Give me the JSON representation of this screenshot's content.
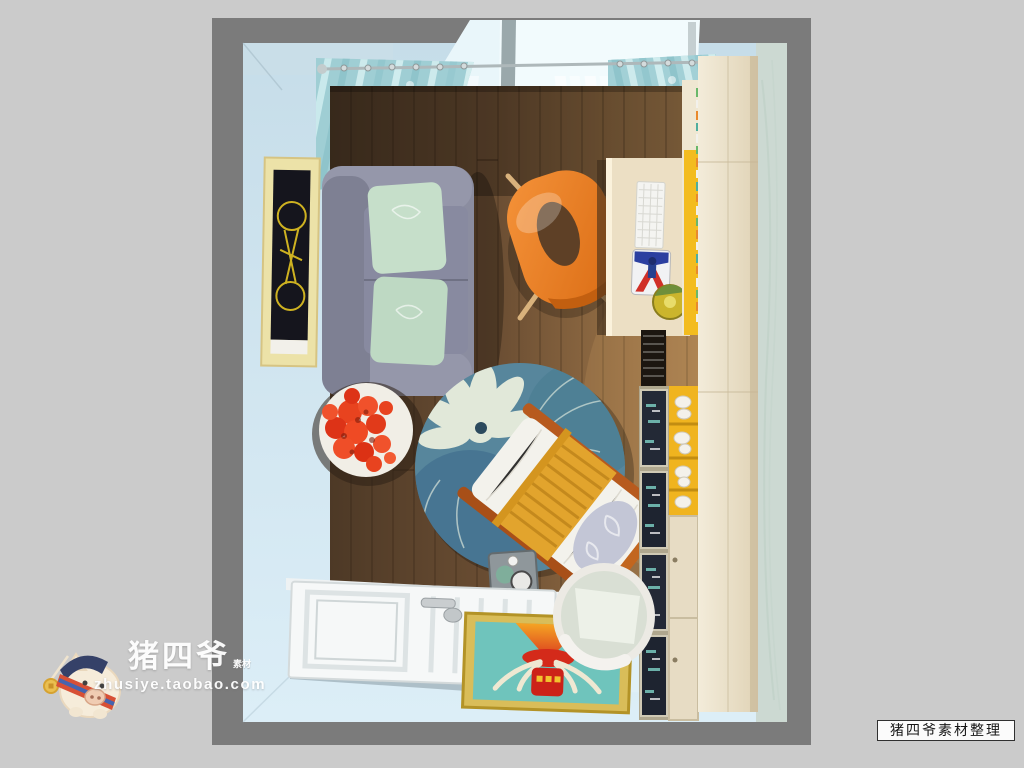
{
  "watermark": {
    "brand": "猪四爷",
    "badge": "素材",
    "url": "zhusiye.taobao.com"
  },
  "footer_label": {
    "text": "猪四爷素材整理"
  },
  "scene": {
    "description_objects": [
      "light-blue-walls",
      "bright-window",
      "curtain-rod",
      "teal-patterned-curtains",
      "white-sheer-curtains",
      "bicycle-wall-art",
      "gray-sofa",
      "mint-pillows",
      "round-side-table",
      "red-rose-bouquet",
      "floral-round-rug",
      "wooden-lounge-chair",
      "yellow-knit-blanket",
      "floral-pillow",
      "tray-stool",
      "orange-designer-chair",
      "desk",
      "white-keyboard",
      "mouse-pad",
      "bookshelf-books",
      "yellow-display-shelf",
      "glass-display-cabinet",
      "wardrobe-cabinet",
      "wood-plank-floor",
      "tile-floor",
      "white-panel-door",
      "deer-artwork-doormat",
      "round-standing-mirror",
      "pig-mascot-logo"
    ]
  },
  "palette": {
    "page_bg": "#cbcbcb",
    "photo_bg": "#7b7b7b",
    "wall_blue": "#cfe3ec",
    "right_wall_green": "#ccd9d2",
    "floor_wood_dark": "#54402c",
    "floor_wood_light": "#a87f50",
    "curtain_teal": "#a2d0d6",
    "sofa_gray": "#8b8da0",
    "pillow_mint": "#c6dfca",
    "accent_orange": "#ee7d23",
    "accent_yellow": "#f0b41f",
    "rug_blue": "#57869c",
    "blanket_yellow": "#e2a42d",
    "rose_red": "#e63a1c",
    "art_teal": "#6fc4bc",
    "frame_gold": "#cfae45",
    "door_white": "#f6f8f8",
    "cabinet_cream": "#ece4cf"
  }
}
